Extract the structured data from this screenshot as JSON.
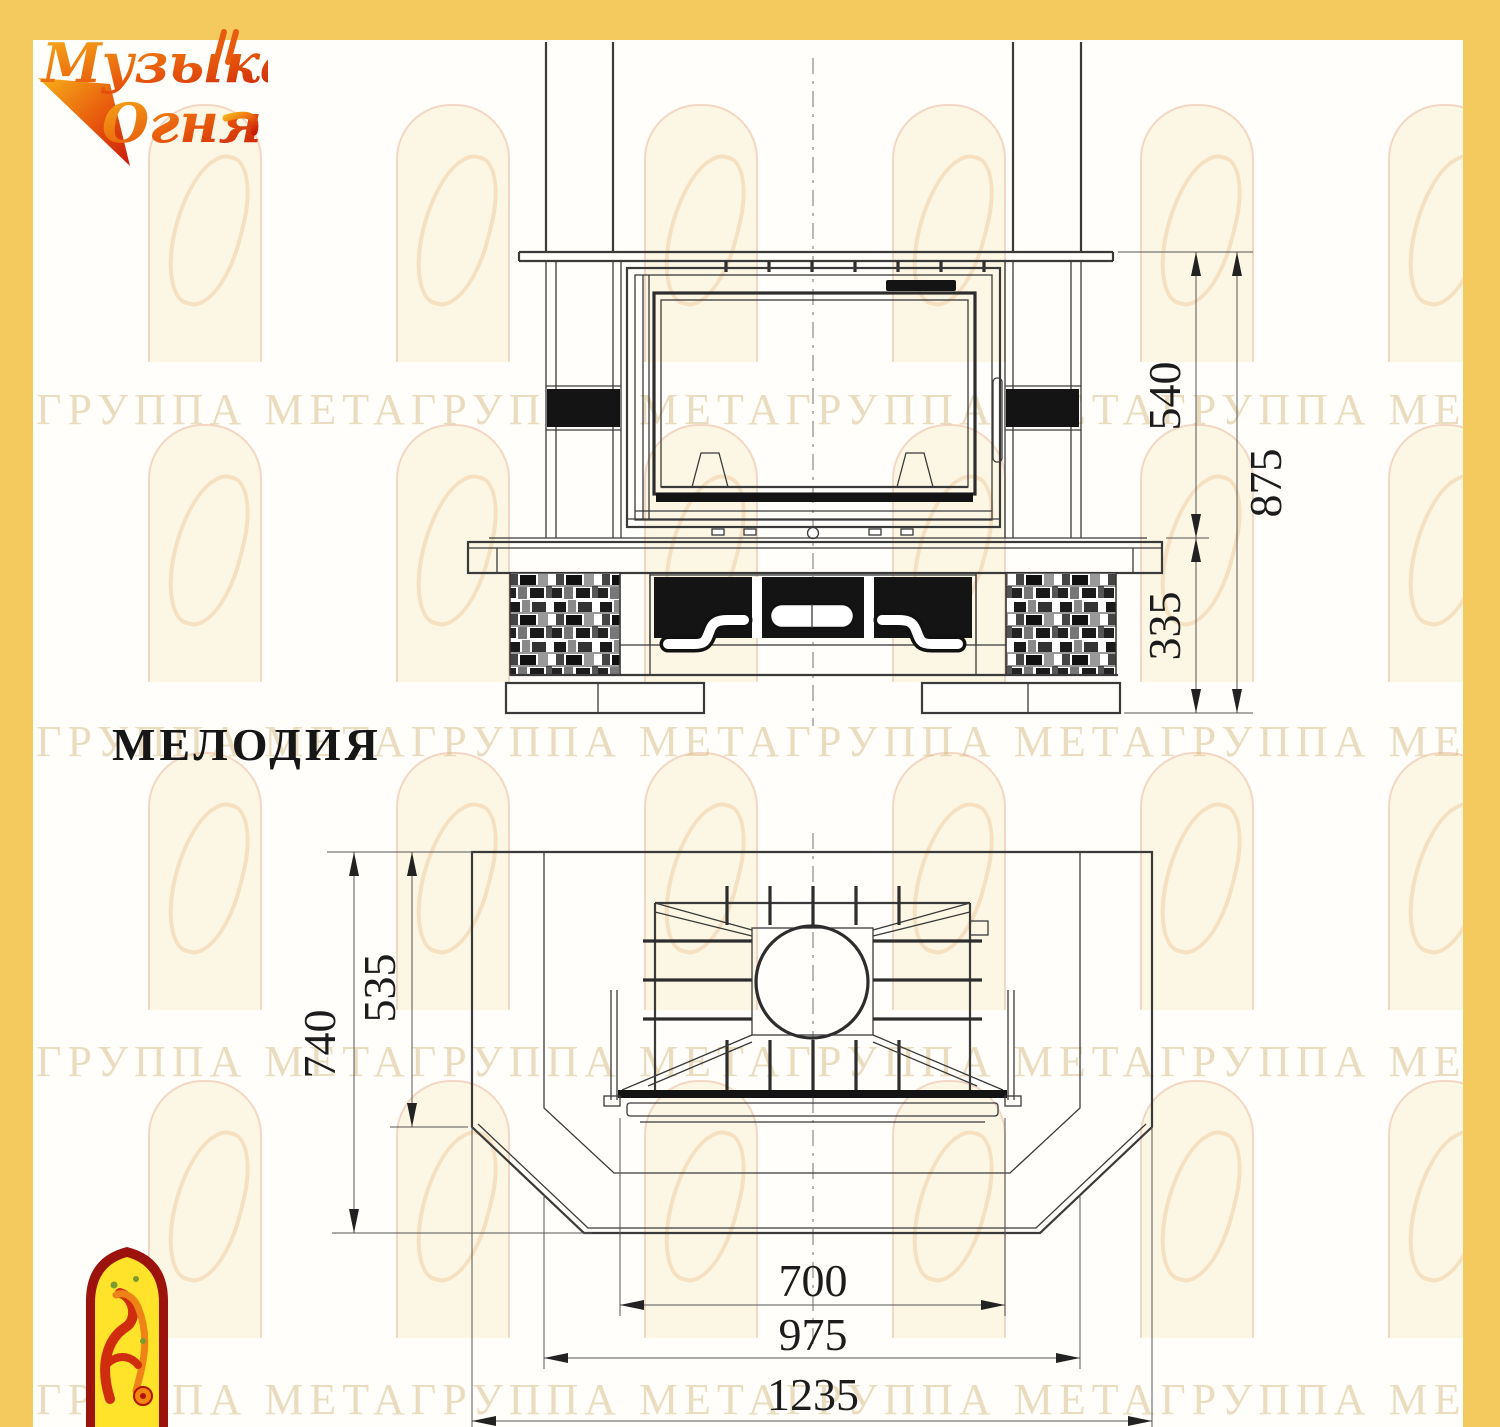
{
  "title": {
    "model_name": "МЕЛОДИЯ"
  },
  "brand_logo": {
    "line1": "Музыка",
    "line2": "Огня"
  },
  "watermark": {
    "text": "ГРУППА МЕТАГРУППА МЕТАГРУППА МЕТАГРУППА МЕТАГРУППА МЕТА"
  },
  "front_view": {
    "dim_firebox_height": "540",
    "dim_total_height": "875",
    "dim_base_height": "335"
  },
  "plan_view": {
    "dim_total_depth": "740",
    "dim_inner_depth": "535",
    "dim_firebox_width": "700",
    "dim_inner_width": "975",
    "dim_total_width": "1235"
  },
  "colors": {
    "border_yellow": "#F4C95E",
    "drawing_line": "#3A3A3A",
    "dim_text": "#1C1C1C",
    "logo_orange": "#F08A1D",
    "logo_red": "#D23B0E",
    "emblem_red": "#9C120C",
    "emblem_yellow": "#FFE32B",
    "watermark_tan": "#D5BC83"
  }
}
